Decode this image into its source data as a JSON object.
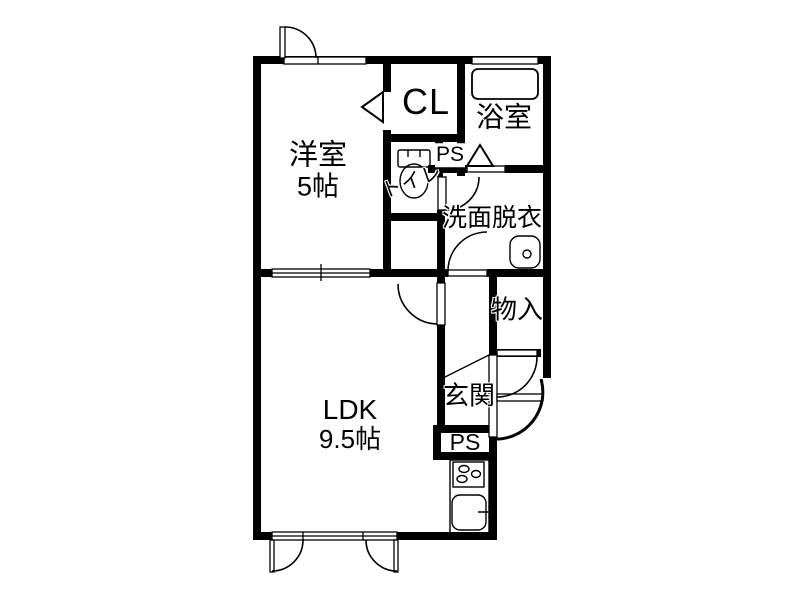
{
  "floorplan": {
    "type": "apartment-floor-plan",
    "line_color": "#000000",
    "background_color": "#ffffff",
    "rooms": {
      "western_room": {
        "name": "洋室",
        "size": "5帖"
      },
      "closet": {
        "name": "CL"
      },
      "bathroom": {
        "name": "浴室"
      },
      "pipe_space_upper": {
        "name": "PS"
      },
      "toilet": {
        "name": "トイレ"
      },
      "washroom": {
        "name": "洗面脱衣"
      },
      "storage": {
        "name": "物入"
      },
      "entrance": {
        "name": "玄関"
      },
      "pipe_space_lower": {
        "name": "PS"
      },
      "ldk": {
        "name": "LDK",
        "size": "9.5帖"
      }
    }
  }
}
